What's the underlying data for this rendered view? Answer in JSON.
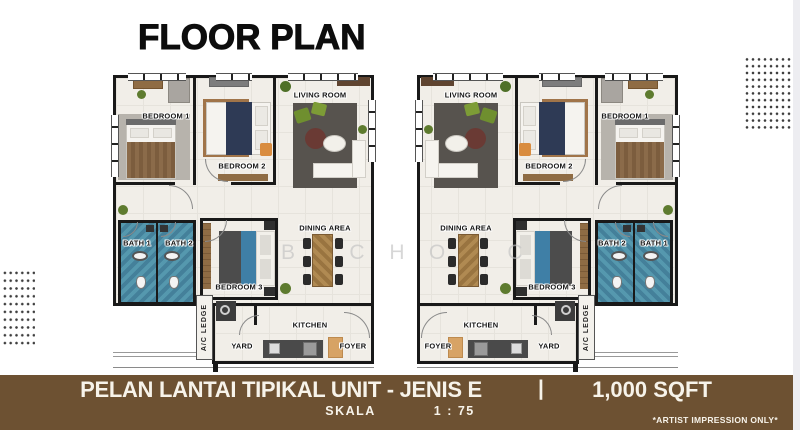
{
  "header": {
    "title": "FLOOR PLAN"
  },
  "rooms": {
    "bedroom1": "BEDROOM 1",
    "bedroom2": "BEDROOM 2",
    "bedroom3": "BEDROOM 3",
    "living_room": "LIVING ROOM",
    "dining_area": "DINING AREA",
    "bath1": "BATH 1",
    "bath2": "BATH 2",
    "kitchen": "KITCHEN",
    "yard": "YARD",
    "foyer": "FOYER",
    "ac_ledge": "A/C LEDGE"
  },
  "watermark": {
    "letters": [
      "B",
      "C",
      "H",
      "O",
      "C"
    ]
  },
  "banner": {
    "title": "PELAN LANTAI TIPIKAL UNIT - JENIS E",
    "separator": "|",
    "area": "1,000 SQFT",
    "scale_label": "SKALA",
    "scale_value": "1 : 75",
    "disclaimer": "*ARTIST IMPRESSION ONLY*"
  },
  "colors": {
    "banner_bg": "#6d5132",
    "banner_text": "#f7f3ea",
    "wall": "#191919",
    "floor": "#f1eee8",
    "bath_tile": "#4e93aa",
    "accent_green": "#6f8f2f",
    "accent_wood": "#b08a52"
  }
}
